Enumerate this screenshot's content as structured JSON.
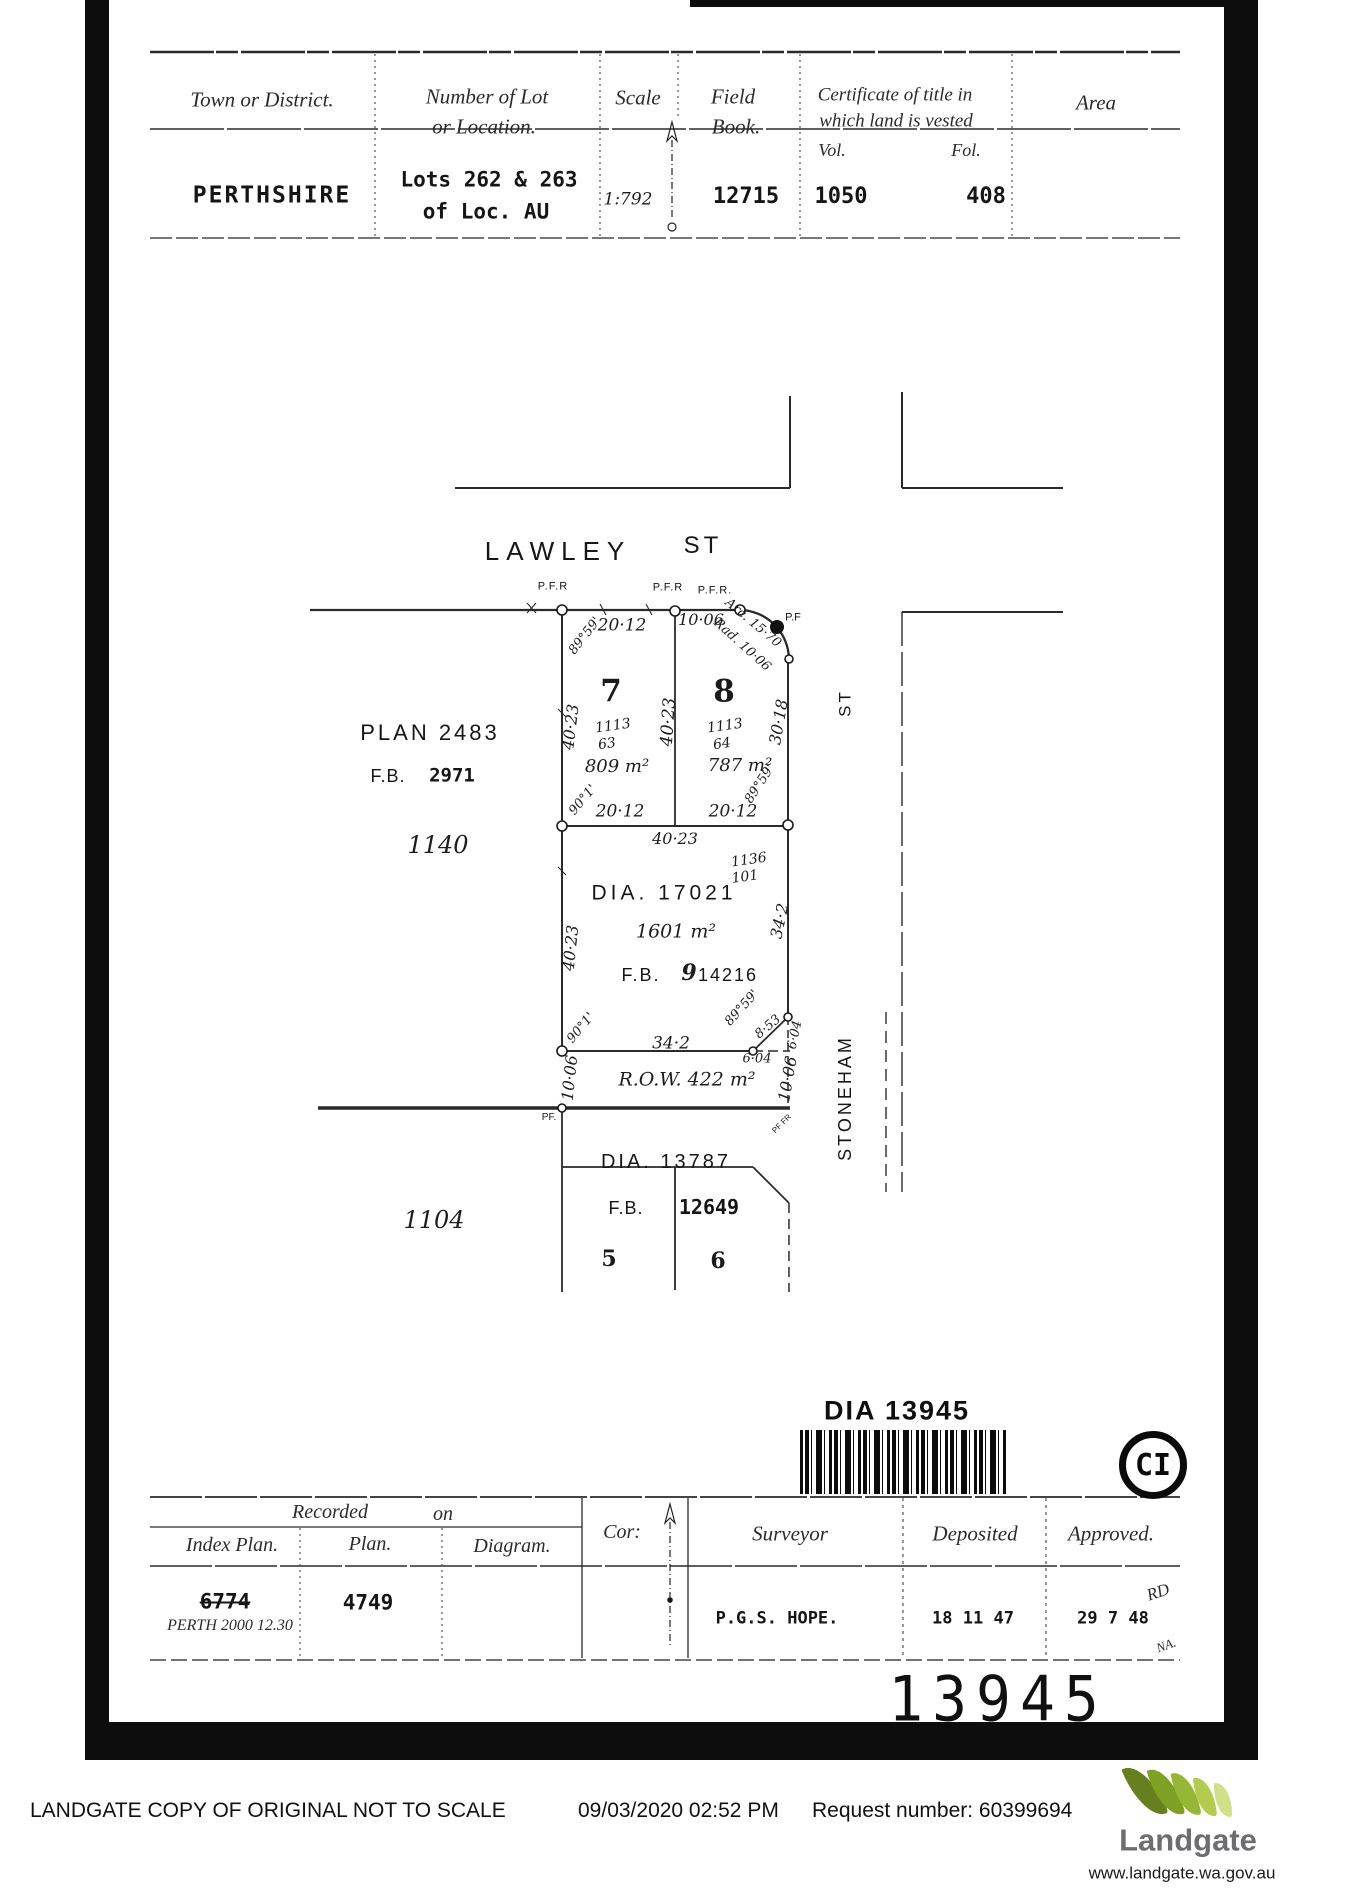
{
  "header_table": {
    "col_district": "Town or District.",
    "col_lot_1": "Number of Lot",
    "col_lot_2": "or Location.",
    "col_scale": "Scale",
    "col_fb_1": "Field",
    "col_fb_2": "Book.",
    "col_cert_1": "Certificate of title in",
    "col_cert_2": "which land is vested",
    "col_vol": "Vol.",
    "col_fol": "Fol.",
    "col_area": "Area",
    "district": "PERTHSHIRE",
    "lots_1": "Lots 262 & 263",
    "lots_2": "of Loc. AU",
    "scale": "1:792",
    "field_book": "12715",
    "vol": "1050",
    "fol": "408",
    "area": ""
  },
  "plan": {
    "lawley": "LAWLEY",
    "lawley_st": "ST",
    "stoneham": "STONEHAM",
    "stoneham_st": "ST",
    "plan_ref": "PLAN  2483",
    "fb_ref_label": "F.B.",
    "fb_ref": "2971",
    "loc_1140": "1140",
    "loc_1104": "1104",
    "pfr1": "P.F.R",
    "pfr2": "P.F.R",
    "pfr3": "P.F.R.",
    "pf_curve": "P.F",
    "dim_2012_top": "20·12",
    "dim_1006_top": "10·06",
    "arc": "Arc. 15·70",
    "rad": "Rad. 10·06",
    "ang_nw": "89°59'",
    "dim_4023_left": "40·23",
    "dim_4023_mid": "40·23",
    "dim_3018": "30·18",
    "lot7": "7",
    "lot7_frac_n": "1113",
    "lot7_frac_d": "63",
    "lot7_area": "809 m²",
    "lot8": "8",
    "lot8_frac_n": "1113",
    "lot8_frac_d": "64",
    "lot8_area": "787 m²",
    "ang_sw7": "90°1'",
    "dim_2012_b7": "20·12",
    "dim_2012_b8": "20·12",
    "ang_se8": "89°59'",
    "dim_4023_dia_top": "40·23",
    "dia_frac_n": "1136",
    "dia_frac_d": "101",
    "dia_label": "DIA.   17021",
    "dia_area": "1601 m²",
    "dia_fb": "F.B.",
    "dia_fb_9": "9",
    "dia_fb_num": "14216",
    "dim_4023_dia_left": "40·23",
    "dim_342_right": "34·2",
    "ang_sw_dia": "90°1'",
    "dim_342_bottom": "34·2",
    "ang_se_dia": "89°59'",
    "dim_853": "8·53",
    "dim_604_a": "6·04",
    "dim_604_b": "6·04",
    "row_label": "R.O.W.  422 m²",
    "dim_1006_row_l": "10·06",
    "dim_1006_row_r": "10·06",
    "pf_row": "PF.",
    "pf_small": "PF FR",
    "dia2_label": "DIA.   13787",
    "dia2_fb_label": "F.B.",
    "dia2_fb": "12649",
    "lot5": "5",
    "lot6": "6"
  },
  "stamp": {
    "dia_number": "DIA 13945",
    "ci": "CI",
    "big_number": "13945"
  },
  "footer_table": {
    "recorded": "Recorded",
    "on": "on",
    "col_index": "Index Plan.",
    "col_plan": "Plan.",
    "col_diagram": "Diagram.",
    "col_cor": "Cor:",
    "col_surveyor": "Surveyor",
    "col_deposited": "Deposited",
    "col_approved": "Approved.",
    "index_plan_old": "6774",
    "index_plan_new": "PERTH 2000 12.30",
    "plan_value": "4749",
    "surveyor": "P.G.S. HOPE.",
    "deposited": "18  11  47",
    "approved": "29  7  48",
    "initials_1": "RD",
    "initials_2": "NA."
  },
  "landgate": {
    "copy_text": "LANDGATE COPY OF ORIGINAL NOT TO SCALE",
    "datetime": "09/03/2020 02:52 PM",
    "request": "Request number: 60399694",
    "brand": "Landgate",
    "url": "www.landgate.wa.gov.au"
  },
  "colors": {
    "ink": "#1c1c1c",
    "brand_grey": "#6d6e71",
    "greens": [
      "#66801f",
      "#7fa123",
      "#95b735",
      "#b3cc4e",
      "#cfe089"
    ]
  }
}
